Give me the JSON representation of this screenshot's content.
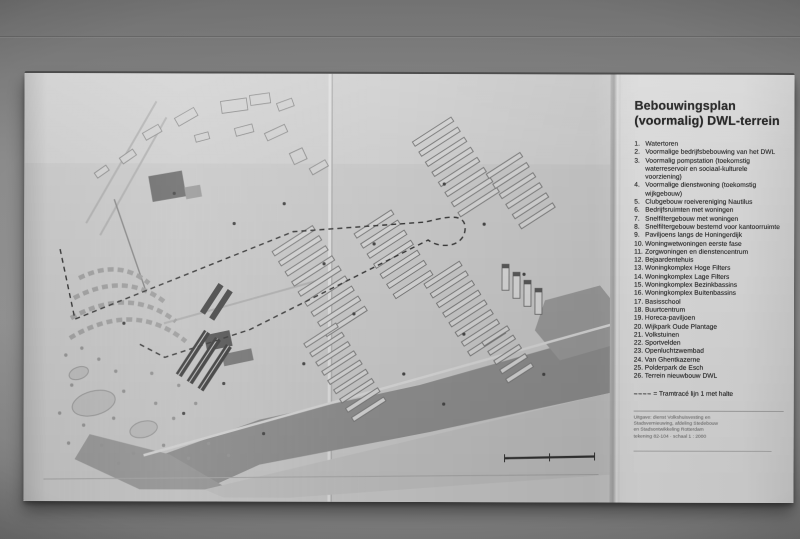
{
  "colors": {
    "backdrop": "#7e7e7e",
    "paper_map": "#c9c9c9",
    "paper_legend": "#d8d8d8",
    "water": "#8f8f8f",
    "ink": "#2e2e2e"
  },
  "legend": {
    "title": [
      "Bebouwingsplan",
      "(voormalig) DWL-terrein"
    ],
    "items": [
      {
        "num": "1.",
        "label": "Watertoren"
      },
      {
        "num": "2.",
        "label": "Voormalige bedrijfsbebouwing van het DWL"
      },
      {
        "num": "3.",
        "label": "Voormalig pompstation (toekomstig waterreservoir en sociaal-kulturele voorziening)"
      },
      {
        "num": "4.",
        "label": "Voormalige dienstwoning (toekomstig wijkgebouw)"
      },
      {
        "num": "5.",
        "label": "Clubgebouw roeivereniging Nautilus"
      },
      {
        "num": "6.",
        "label": "Bedrijfsruimten met woningen"
      },
      {
        "num": "7.",
        "label": "Snelfiltergebouw met woningen"
      },
      {
        "num": "8.",
        "label": "Snelfiltergebouw bestemd voor kantoorruimte"
      },
      {
        "num": "9.",
        "label": "Paviljoens langs de Honingerdijk"
      },
      {
        "num": "10.",
        "label": "Woningwetwoningen eerste fase"
      },
      {
        "num": "11.",
        "label": "Zorgwoningen en dienstencentrum"
      },
      {
        "num": "12.",
        "label": "Bejaardentehuis"
      },
      {
        "num": "13.",
        "label": "Woningkomplex Hoge Filters"
      },
      {
        "num": "14.",
        "label": "Woningkomplex Lage Filters"
      },
      {
        "num": "15.",
        "label": "Woningkomplex Bezinkbassins"
      },
      {
        "num": "16.",
        "label": "Woningkomplex Buitenbassins"
      },
      {
        "num": "17.",
        "label": "Basisschool"
      },
      {
        "num": "18.",
        "label": "Buurtcentrum"
      },
      {
        "num": "19.",
        "label": "Horeca-paviljoen"
      },
      {
        "num": "20.",
        "label": "Wijkpark Oude Plantage"
      },
      {
        "num": "21.",
        "label": "Volkstuinen"
      },
      {
        "num": "22.",
        "label": "Sportvelden"
      },
      {
        "num": "23.",
        "label": "Openluchtzwembad"
      },
      {
        "num": "24.",
        "label": "Van Ghentkazerne"
      },
      {
        "num": "25.",
        "label": "Polderpark de Esch"
      },
      {
        "num": "26.",
        "label": "Terrein nieuwbouw DWL"
      }
    ],
    "route_note_symbol": "– – – –",
    "route_note_text": "= Tramtracé lijn 1 met halte",
    "colophon": [
      "Uitgave: dienst Volkshuisvesting en",
      "Stadsvernieuwing, afdeling Stedebouw",
      "en Stadsontwikkeling Rotterdam",
      "tekening 82-104 · schaal 1 : 2000"
    ]
  }
}
